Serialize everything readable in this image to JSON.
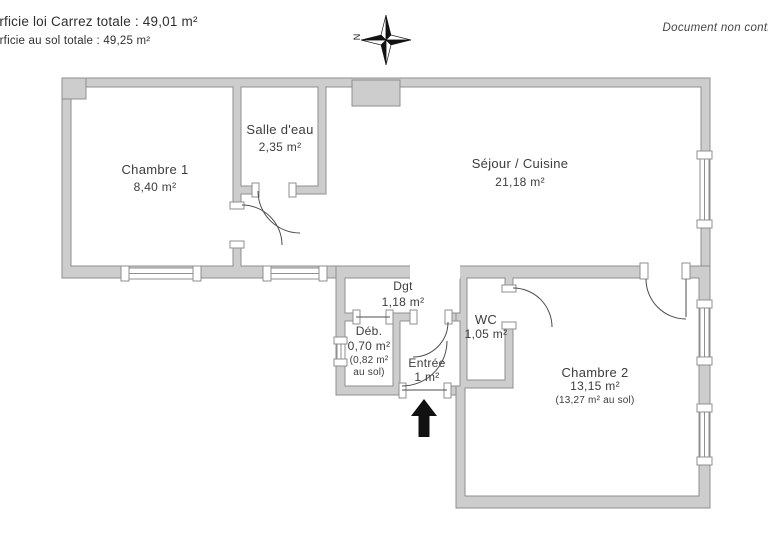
{
  "header": {
    "carrez_line": "Superficie loi Carrez totale :  49,01 m²",
    "floor_line": "Superficie au sol totale :  49,25 m²",
    "disclaimer": "Document non contractuel"
  },
  "compass": {
    "north_label": "N"
  },
  "rooms": {
    "chambre1": {
      "name": "Chambre 1",
      "area": "8,40 m²"
    },
    "salle_eau": {
      "name": "Salle d'eau",
      "area": "2,35 m²"
    },
    "sejour": {
      "name": "Séjour / Cuisine",
      "area": "21,18 m²"
    },
    "dgt": {
      "name": "Dgt",
      "area": "1,18 m²"
    },
    "deb": {
      "name": "Déb.",
      "area": "0,70 m²",
      "note_line1": "(0,82 m²",
      "note_line2": "au sol)"
    },
    "entree": {
      "name": "Entrée",
      "area": "1 m²"
    },
    "wc": {
      "name": "WC",
      "area": "1,05 m²"
    },
    "chambre2": {
      "name": "Chambre 2",
      "area": "13,15 m²",
      "note": "(13,27 m² au sol)"
    }
  },
  "colors": {
    "wall-fill": "#cdcdcd",
    "wall-edge": "#8f8f8f",
    "text": "#3d3d3d",
    "arrow": "#111111"
  }
}
